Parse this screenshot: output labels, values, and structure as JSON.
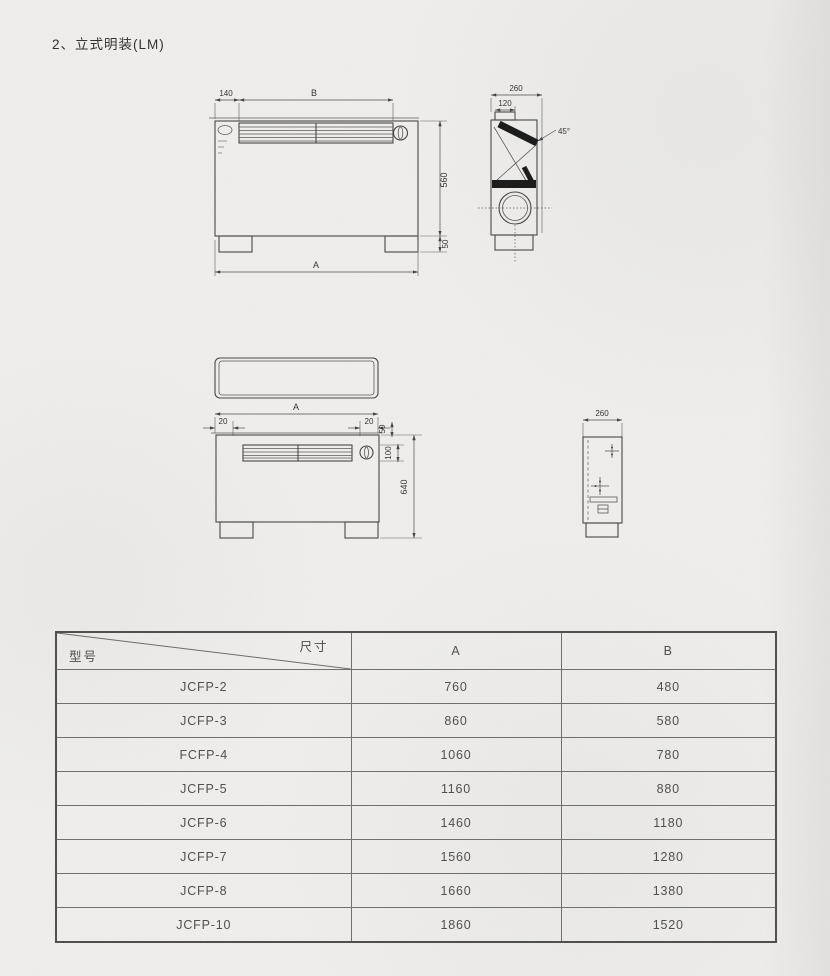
{
  "page": {
    "title": "2、立式明装(LM)"
  },
  "drawings": {
    "front_view": {
      "dim_inset": "140",
      "dim_grille_width": "B",
      "dim_height": "560",
      "dim_foot": "50",
      "dim_width": "A"
    },
    "side_view_top": {
      "dim_depth": "260",
      "dim_outlet": "120",
      "dim_angle": "45°"
    },
    "front_view_2": {
      "dim_width": "A",
      "dim_inset_left": "20",
      "dim_inset_right": "20",
      "dim_top_offset": "50",
      "dim_grille_height": "100",
      "dim_height": "640"
    },
    "side_view_bottom": {
      "dim_depth": "260"
    }
  },
  "table": {
    "header": {
      "col_model": "型号",
      "col_dim": "尺寸",
      "col_a": "A",
      "col_b": "B"
    },
    "rows": [
      {
        "model": "JCFP-2",
        "a": "760",
        "b": "480"
      },
      {
        "model": "JCFP-3",
        "a": "860",
        "b": "580"
      },
      {
        "model": "FCFP-4",
        "a": "1060",
        "b": "780"
      },
      {
        "model": "JCFP-5",
        "a": "1160",
        "b": "880"
      },
      {
        "model": "JCFP-6",
        "a": "1460",
        "b": "1180"
      },
      {
        "model": "JCFP-7",
        "a": "1560",
        "b": "1280"
      },
      {
        "model": "JCFP-8",
        "a": "1660",
        "b": "1380"
      },
      {
        "model": "JCFP-10",
        "a": "1860",
        "b": "1520"
      }
    ]
  }
}
